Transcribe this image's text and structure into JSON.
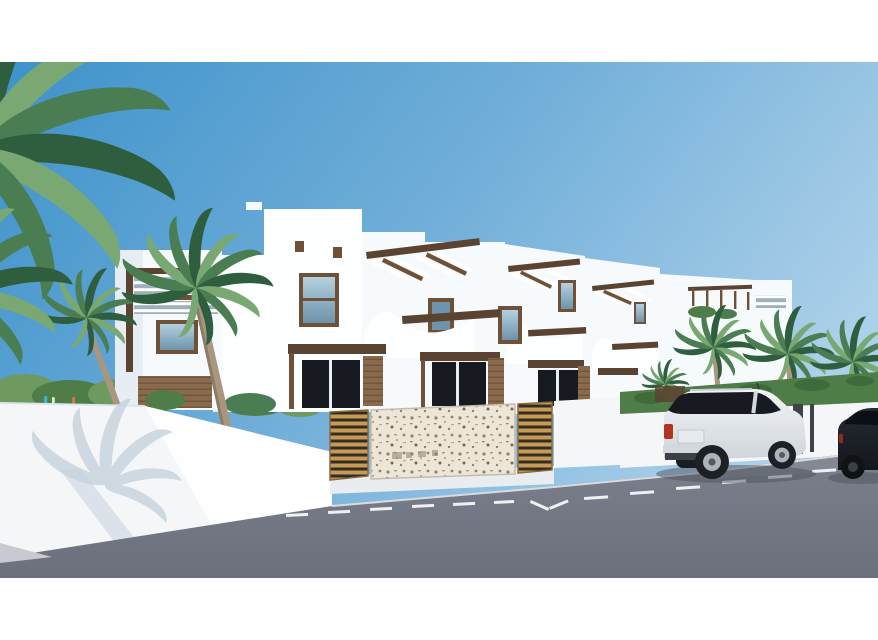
{
  "meta": {
    "kind": "architectural-3d-render",
    "description": "CGI rendering of a row of modern white Mediterranean townhouses with wooden pergolas and curved balcony parapets, palm trees, a street wall with a gabion stone panel and golden wooden slat fences, an asphalt road with dashed white parking markings, a white SUV parked at the kerb and a dark car at the right edge. White letterbox bands at top and bottom.",
    "visible_text": "none"
  },
  "frame": {
    "top_margin_px": 62,
    "bottom_margin_px": 62,
    "margin_color": "#ffffff"
  },
  "objects": {
    "sky": "clear blue gradient sky, darker at upper left",
    "townhouse_row": "four attached two-storey white units receding to the right",
    "left_annex": "detached white tower with dark-wood pergola and window",
    "street_fence": "white perimeter wall, central gabion stone panel, golden wood slat panels",
    "vegetation": "palm trees left and right, green hedge on right wall, shrubs behind wall",
    "road": "grey asphalt with dashed white parking-bay markings",
    "vehicles": [
      "white SUV parked facing away",
      "dark car partially visible at right edge"
    ],
    "figures": "two tiny distant people behind the left wall"
  },
  "colors": {
    "white": "#ffffff",
    "sky_left": "#3e92ca",
    "sky_mid": "#74b0da",
    "sky_right": "#abd0e9",
    "building_light": "#f6fafc",
    "building_bright": "#fcfeff",
    "building_shade": "#e6edf3",
    "wall_white": "#f4f6f8",
    "wall_lit": "#fefefe",
    "wall_shadow": "#c6d2dd",
    "wood_dark": "#5a4330",
    "wood_mid": "#6e5136",
    "cladding": "#8a6a4d",
    "plank_line": "#6b5138",
    "slat_bg": "#9fb0bd",
    "fence_gold": "#c79a55",
    "fence_gap": "#332d23",
    "stone_bg": "#ede6d7",
    "stone_dark": "#8d8472",
    "hedge": "#4f7d48",
    "hedge_dark": "#3f6a3a",
    "grass": "#6f9a5f",
    "leaf_dark": "#2f5e3f",
    "leaf_mid": "#4a7d52",
    "leaf_light": "#7aa873",
    "trunk": "#a8967e",
    "road_top": "#7b808c",
    "road_bottom": "#6b707c",
    "road_far": "#8d919c",
    "marking": "#eef0f2",
    "sidewalk": "#c7cad0",
    "glass_light": "#b5d0e0",
    "glass_deep": "#6e93aa",
    "glass_dark": "#171b21",
    "suv_body": "#f2f4f6",
    "suv_shade": "#cfd5db",
    "suv_trim": "#d3d8dd",
    "bumper_dark": "#3c4046",
    "tire": "#1d2025",
    "rim": "#aeb3ba",
    "taillight": "#b23425",
    "dark_car": "#262b33",
    "dark_car_deep": "#14171c",
    "ground_shadow": "#4e525c",
    "post_dark": "#3f4348",
    "person_teal": "#3fb3c9",
    "person_light": "#e8e4da",
    "person_orange": "#d8763f"
  }
}
